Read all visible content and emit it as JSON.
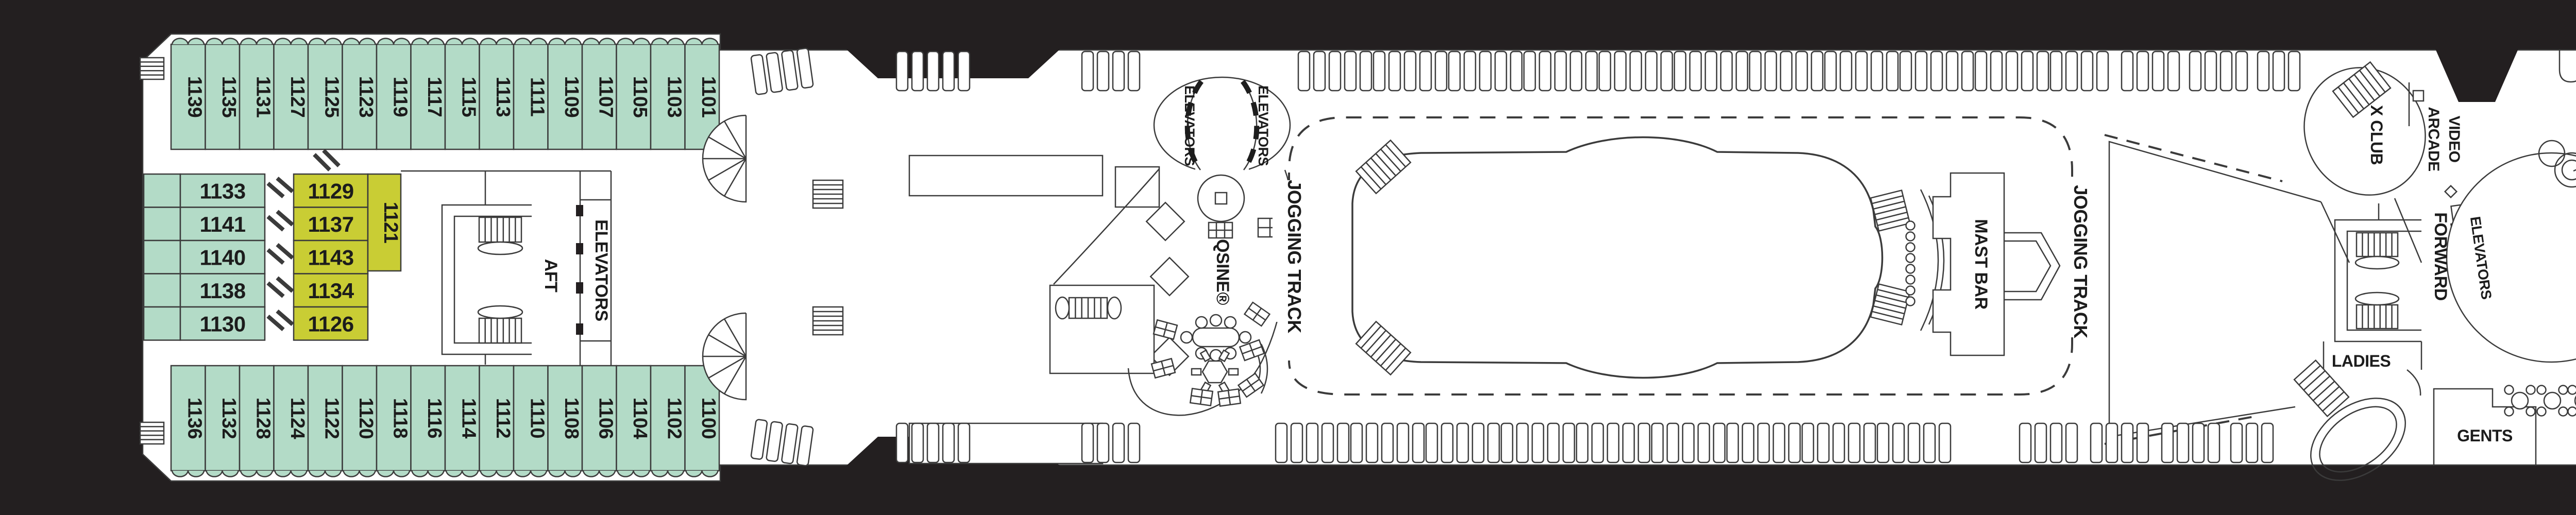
{
  "deck_plan": {
    "colors": {
      "hull": "#231f20",
      "deck": "#ffffff",
      "cabin_teal": "#b3dbc7",
      "cabin_yellow": "#c9cd34",
      "line": "#3b3b3b",
      "text": "#1c1c1c"
    },
    "cabins": {
      "top_row": [
        "1139",
        "1135",
        "1131",
        "1127",
        "1125",
        "1123",
        "1119",
        "1117",
        "1115",
        "1113",
        "1111",
        "1109",
        "1107",
        "1105",
        "1103",
        "1101"
      ],
      "bottom_row": [
        "1136",
        "1132",
        "1128",
        "1124",
        "1122",
        "1120",
        "1118",
        "1116",
        "1114",
        "1112",
        "1110",
        "1108",
        "1106",
        "1104",
        "1102",
        "1100"
      ],
      "mid_teal": [
        "1133",
        "1141",
        "1140",
        "1138",
        "1130"
      ],
      "mid_yellow": [
        "1129",
        "1137",
        "1143",
        "1134",
        "1126"
      ],
      "mid_yellow_vertical": "1121"
    },
    "labels": {
      "aft": "AFT",
      "aft_elevators": "ELEVATORS",
      "mid_elevators_left": "ELEVATORS",
      "mid_elevators_right": "ELEVATORS",
      "qsine": "QSINE®",
      "jogging_track_aft": "JOGGING TRACK",
      "jogging_track_fwd": "JOGGING TRACK",
      "mast_bar": "MAST BAR",
      "x_club": "X CLUB",
      "video_arcade_line1": "VIDEO",
      "video_arcade_line2": "ARCADE",
      "forward": "FORWARD",
      "fwd_elevators": "ELEVATORS",
      "ladies": "LADIES",
      "gents": "GENTS",
      "fun_factory": "FUN FACTORY",
      "constellation_line1": "CONSTELLATION",
      "constellation_line2": "LOUNGE"
    }
  }
}
